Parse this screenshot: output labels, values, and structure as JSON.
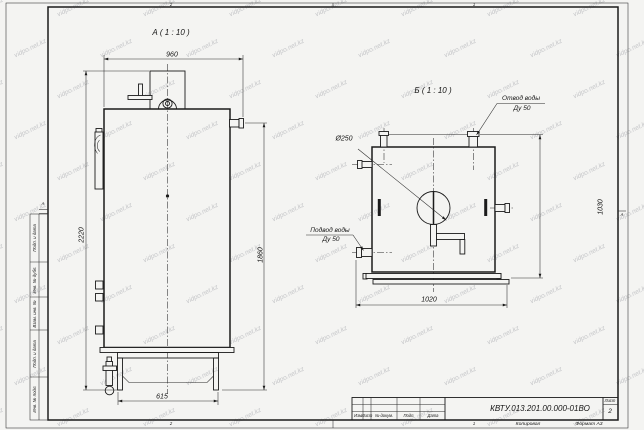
{
  "sheet": {
    "background": "#f4f4f2",
    "line_color": "#1b1b1b",
    "watermark_text": "vidpo.net.kz",
    "zones": {
      "top_left": "2",
      "top_right": "1",
      "bottom_left": "2",
      "bottom_right": "1",
      "left": "А",
      "right": "А"
    }
  },
  "view_a": {
    "title": "А ( 1 : 10 )",
    "dim_width_top": "960",
    "dim_height_overall": "2220",
    "dim_height_body": "1860",
    "dim_base_width": "615"
  },
  "view_b": {
    "title": "Б ( 1 : 10 )",
    "dim_width_bottom": "1020",
    "dim_height_right": "1030",
    "dim_diameter": "Ø250",
    "callout_outlet_line1": "Отвод воды",
    "callout_outlet_line2": "Ду 50",
    "callout_inlet_line1": "Подвод воды",
    "callout_inlet_line2": "Ду 50"
  },
  "margin_column": {
    "cells": [
      "Подп. и дата",
      "Инв. № дубл.",
      "Взам. инв. №",
      "Подп. и дата",
      "Инв. № подл."
    ]
  },
  "title_block": {
    "doc_number": "КВТУ.013.201.00.000-01ВО",
    "col_izm": "Изм",
    "col_list": "Лист",
    "col_ndocum": "№ докум.",
    "col_podp": "Подп.",
    "col_data": "Дата",
    "sheet_label": "Лист",
    "sheet_number": "2",
    "footer_copied": "Копировал",
    "footer_format": "Формат А3"
  }
}
